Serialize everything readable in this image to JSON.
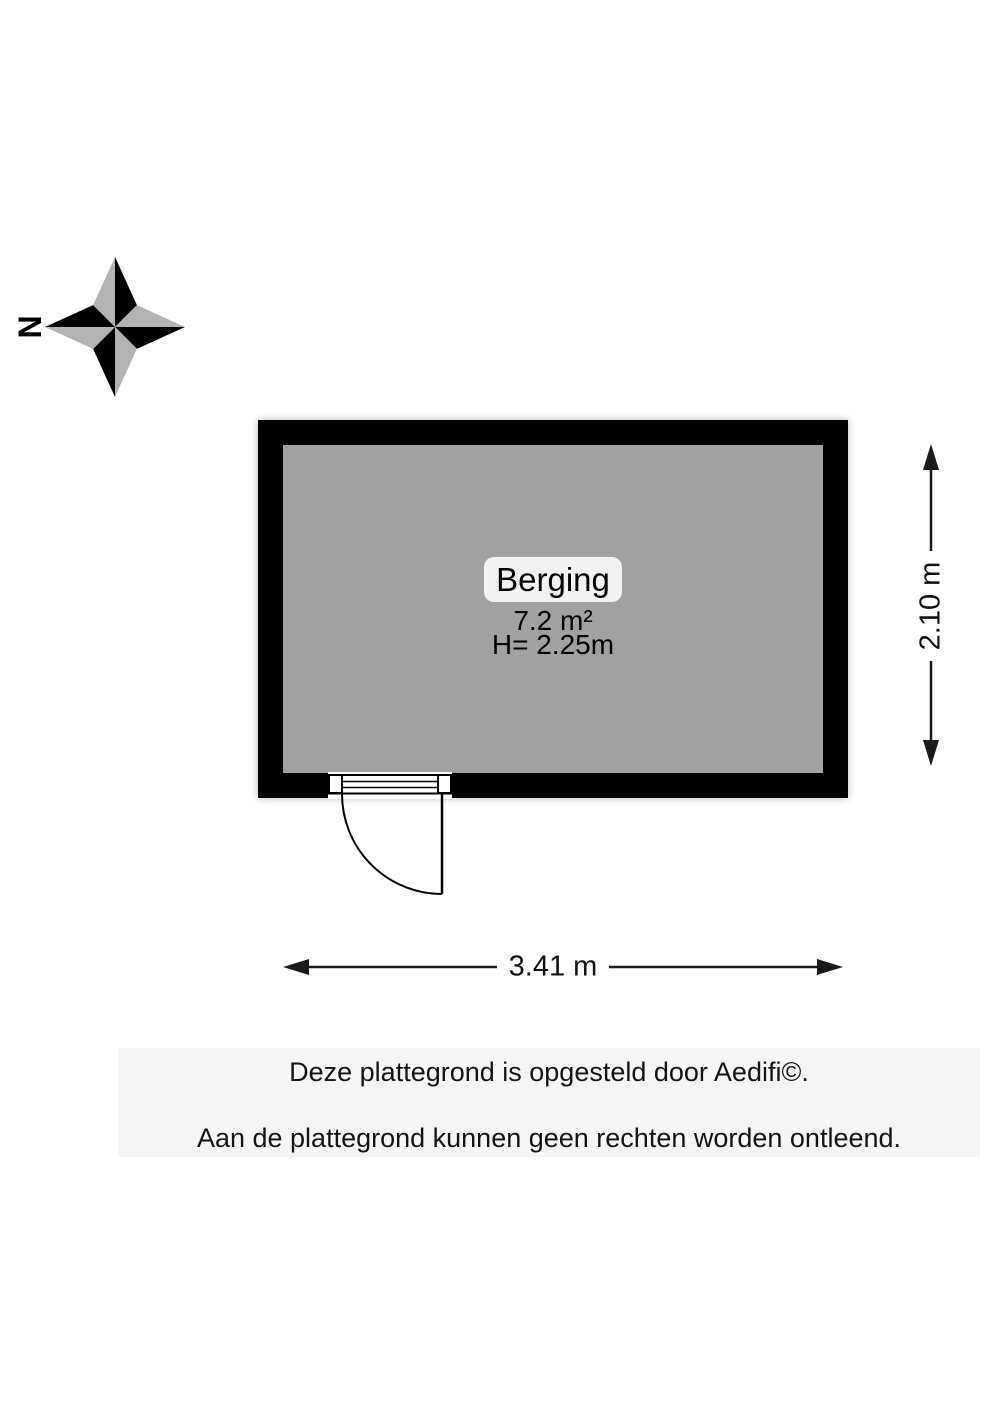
{
  "compass": {
    "north_label": "N"
  },
  "room": {
    "name": "Berging",
    "area": "7.2 m²",
    "ceiling_height": "H= 2.25m"
  },
  "dimensions": {
    "width_label": "3.41 m",
    "height_label": "2.10 m"
  },
  "footer": {
    "line1": "Deze plattegrond is opgesteld door Aedifi©.",
    "line2": "Aan de plattegrond kunnen geen rechten worden ontleend."
  },
  "colors": {
    "wall": "#000000",
    "floor": "#a1a1a1",
    "compass_dark": "#000000",
    "compass_light": "#b3b3b3",
    "dimension_ink": "#1a1a1a"
  }
}
